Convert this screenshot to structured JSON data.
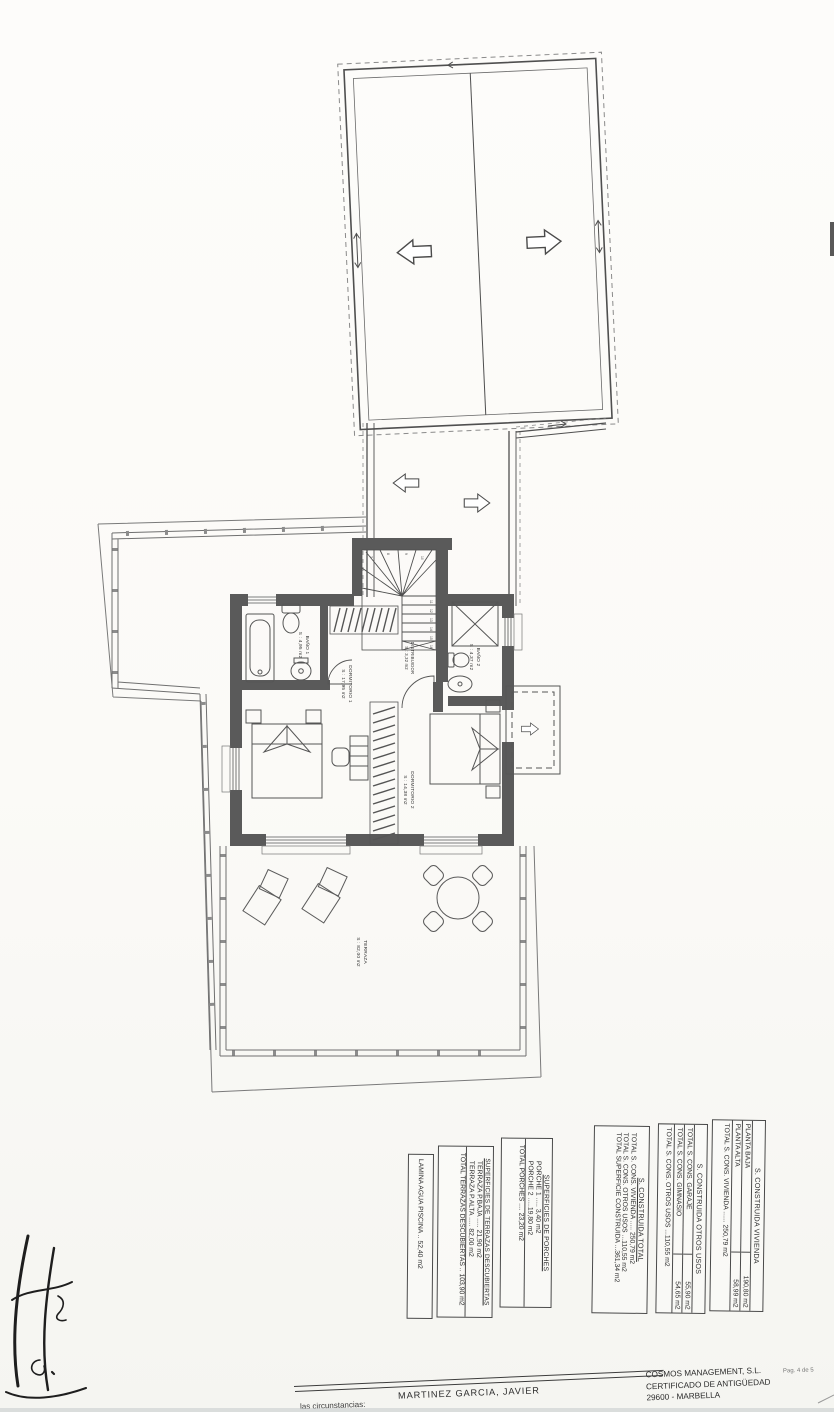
{
  "colors": {
    "paper": "#fbfaf8",
    "ink": "#3a3a3a",
    "wall_fill": "#5a5a5a"
  },
  "plan": {
    "rooms": [
      {
        "label": "BAÑO 1",
        "area": "S : 4,95 m2"
      },
      {
        "label": "DORMITORIO 1",
        "area": "S : 17,95 m2"
      },
      {
        "label": "DISTRIBUIDOR",
        "area": "S : 3,32 m2"
      },
      {
        "label": "BAÑO 2",
        "area": "S : 4,37 m2"
      },
      {
        "label": "DORMITORIO 2",
        "area": "S : 14,38 m2"
      },
      {
        "label": "TERRAZA",
        "area": "S : 82,00 m2"
      }
    ],
    "stair_numbers": [
      "7",
      "8",
      "9",
      "10",
      "11",
      "12",
      "13",
      "14",
      "15",
      "16"
    ]
  },
  "tables": {
    "vivienda": {
      "title": "S. CONSTRUIDA VIVIENDA",
      "rows": [
        [
          "PLANTA BAJA",
          "190,80 m2"
        ],
        [
          "PLANTA ALTA",
          "58,99 m2"
        ]
      ],
      "total": "TOTAL S. CONS. VIVIENDA ...... 250,79 m2"
    },
    "otros": {
      "title": "S. CONSTRUIDA OTROS USOS",
      "rows": [
        [
          "TOTAL S. CONS. GARAJE",
          "55,90 m2"
        ],
        [
          "TOTAL S. CONS. GIMNASIO",
          "54,65 m2"
        ]
      ],
      "total": "TOTAL S. CONS. OTROS USOS ...110,55 m2"
    },
    "total": {
      "title": "S. CONSTRUIDA TOTAL",
      "lines": [
        "TOTAL S. CONS. VIVIENDA ..... 250,79 m2",
        "TOTAL S. CONS. OTROS USOS ...110,55 m2"
      ],
      "grand": "TOTAL SUPERFICIE CONSTRUIDA ...361,34 m2"
    },
    "porches": {
      "title": "SUPERFICIES DE PORCHES",
      "lines": [
        "PORCHE 1 ..... 3,40 m2",
        "PORCHE 2 .....19,80 m2"
      ],
      "total": "TOTAL PORCHES .... 23,20 m2"
    },
    "terrazas": {
      "title": "SUPERFICIES DE TERRAZAS DESCUBIERTAS",
      "lines": [
        "TERRAZA P.BAJA ..... 21,90 m2",
        "TERRAZA P.ALTA ..... 82,00 m2"
      ],
      "total": "TOTAL TERRAZAS DESCUBIERTAS .. 103,90 m2"
    },
    "piscina": {
      "line": "LAMINA AGUA PISCINA .. 52,40 m2"
    }
  },
  "footer": {
    "author": "MARTINEZ GARCIA, JAVIER",
    "company": "COSMOS MANAGEMENT, S.L.",
    "cert": "CERTIFICADO DE ANTIGÜEDAD",
    "city": "29600 - MARBELLA",
    "page_num": "Pag. 4 de 5",
    "partial_note": "las circunstancias:"
  }
}
